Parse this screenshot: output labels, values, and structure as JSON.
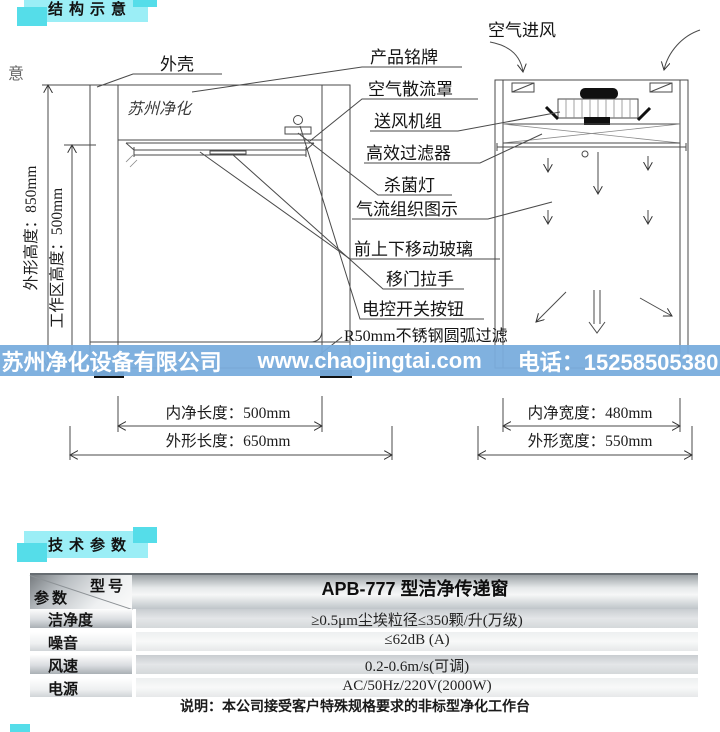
{
  "sections": {
    "structure": "结构示意",
    "params": "技术参数"
  },
  "stray": {
    "top_left": "意"
  },
  "diagram": {
    "device_print": "苏州净化",
    "air_intake": "空气进风",
    "callouts": {
      "shell": "外壳",
      "nameplate": "产品铭牌",
      "diffuser": "空气散流罩",
      "fan_unit": "送风机组",
      "hepa_filter": "高效过滤器",
      "uv_lamp": "杀菌灯",
      "airflow_diagram": "气流组织图示",
      "moving_glass": "前上下移动玻璃",
      "door_handle": "移门拉手",
      "switch_button": "电控开关按钮",
      "arc_filter": "R50mm不锈钢圆弧过滤"
    },
    "dimensions": {
      "outer_height": "外形高度：850mm",
      "work_height": "工作区高度：500mm",
      "inner_length": "内净长度：500mm",
      "outer_length": "外形长度：650mm",
      "inner_width": "内净宽度：480mm",
      "outer_width": "外形宽度：550mm"
    }
  },
  "banner": {
    "company": "苏州净化设备有限公司",
    "website": "www.chaojingtai.com",
    "phone": "电话：15258505380"
  },
  "spec_table": {
    "corner": {
      "model_label": "型号",
      "param_label": "参数"
    },
    "model_value": "APB-777 型洁净传递窗",
    "rows": [
      {
        "label": "洁净度",
        "value": "≥0.5μm尘埃粒径≤350颗/升(万级)"
      },
      {
        "label": "噪音",
        "value": "≤62dB (A)"
      },
      {
        "label": "风速",
        "value": "0.2-0.6m/s(可调)"
      },
      {
        "label": "电源",
        "value": "AC/50Hz/220V(2000W)"
      }
    ],
    "note": "说明：本公司接受客户特殊规格要求的非标型净化工作台"
  },
  "colors": {
    "header_cyan": "#9beef6",
    "header_cyan_dark": "#55dde9",
    "banner_blue": "#79addd",
    "banner_text": "#ffffff",
    "line": "#4a4a4a"
  }
}
